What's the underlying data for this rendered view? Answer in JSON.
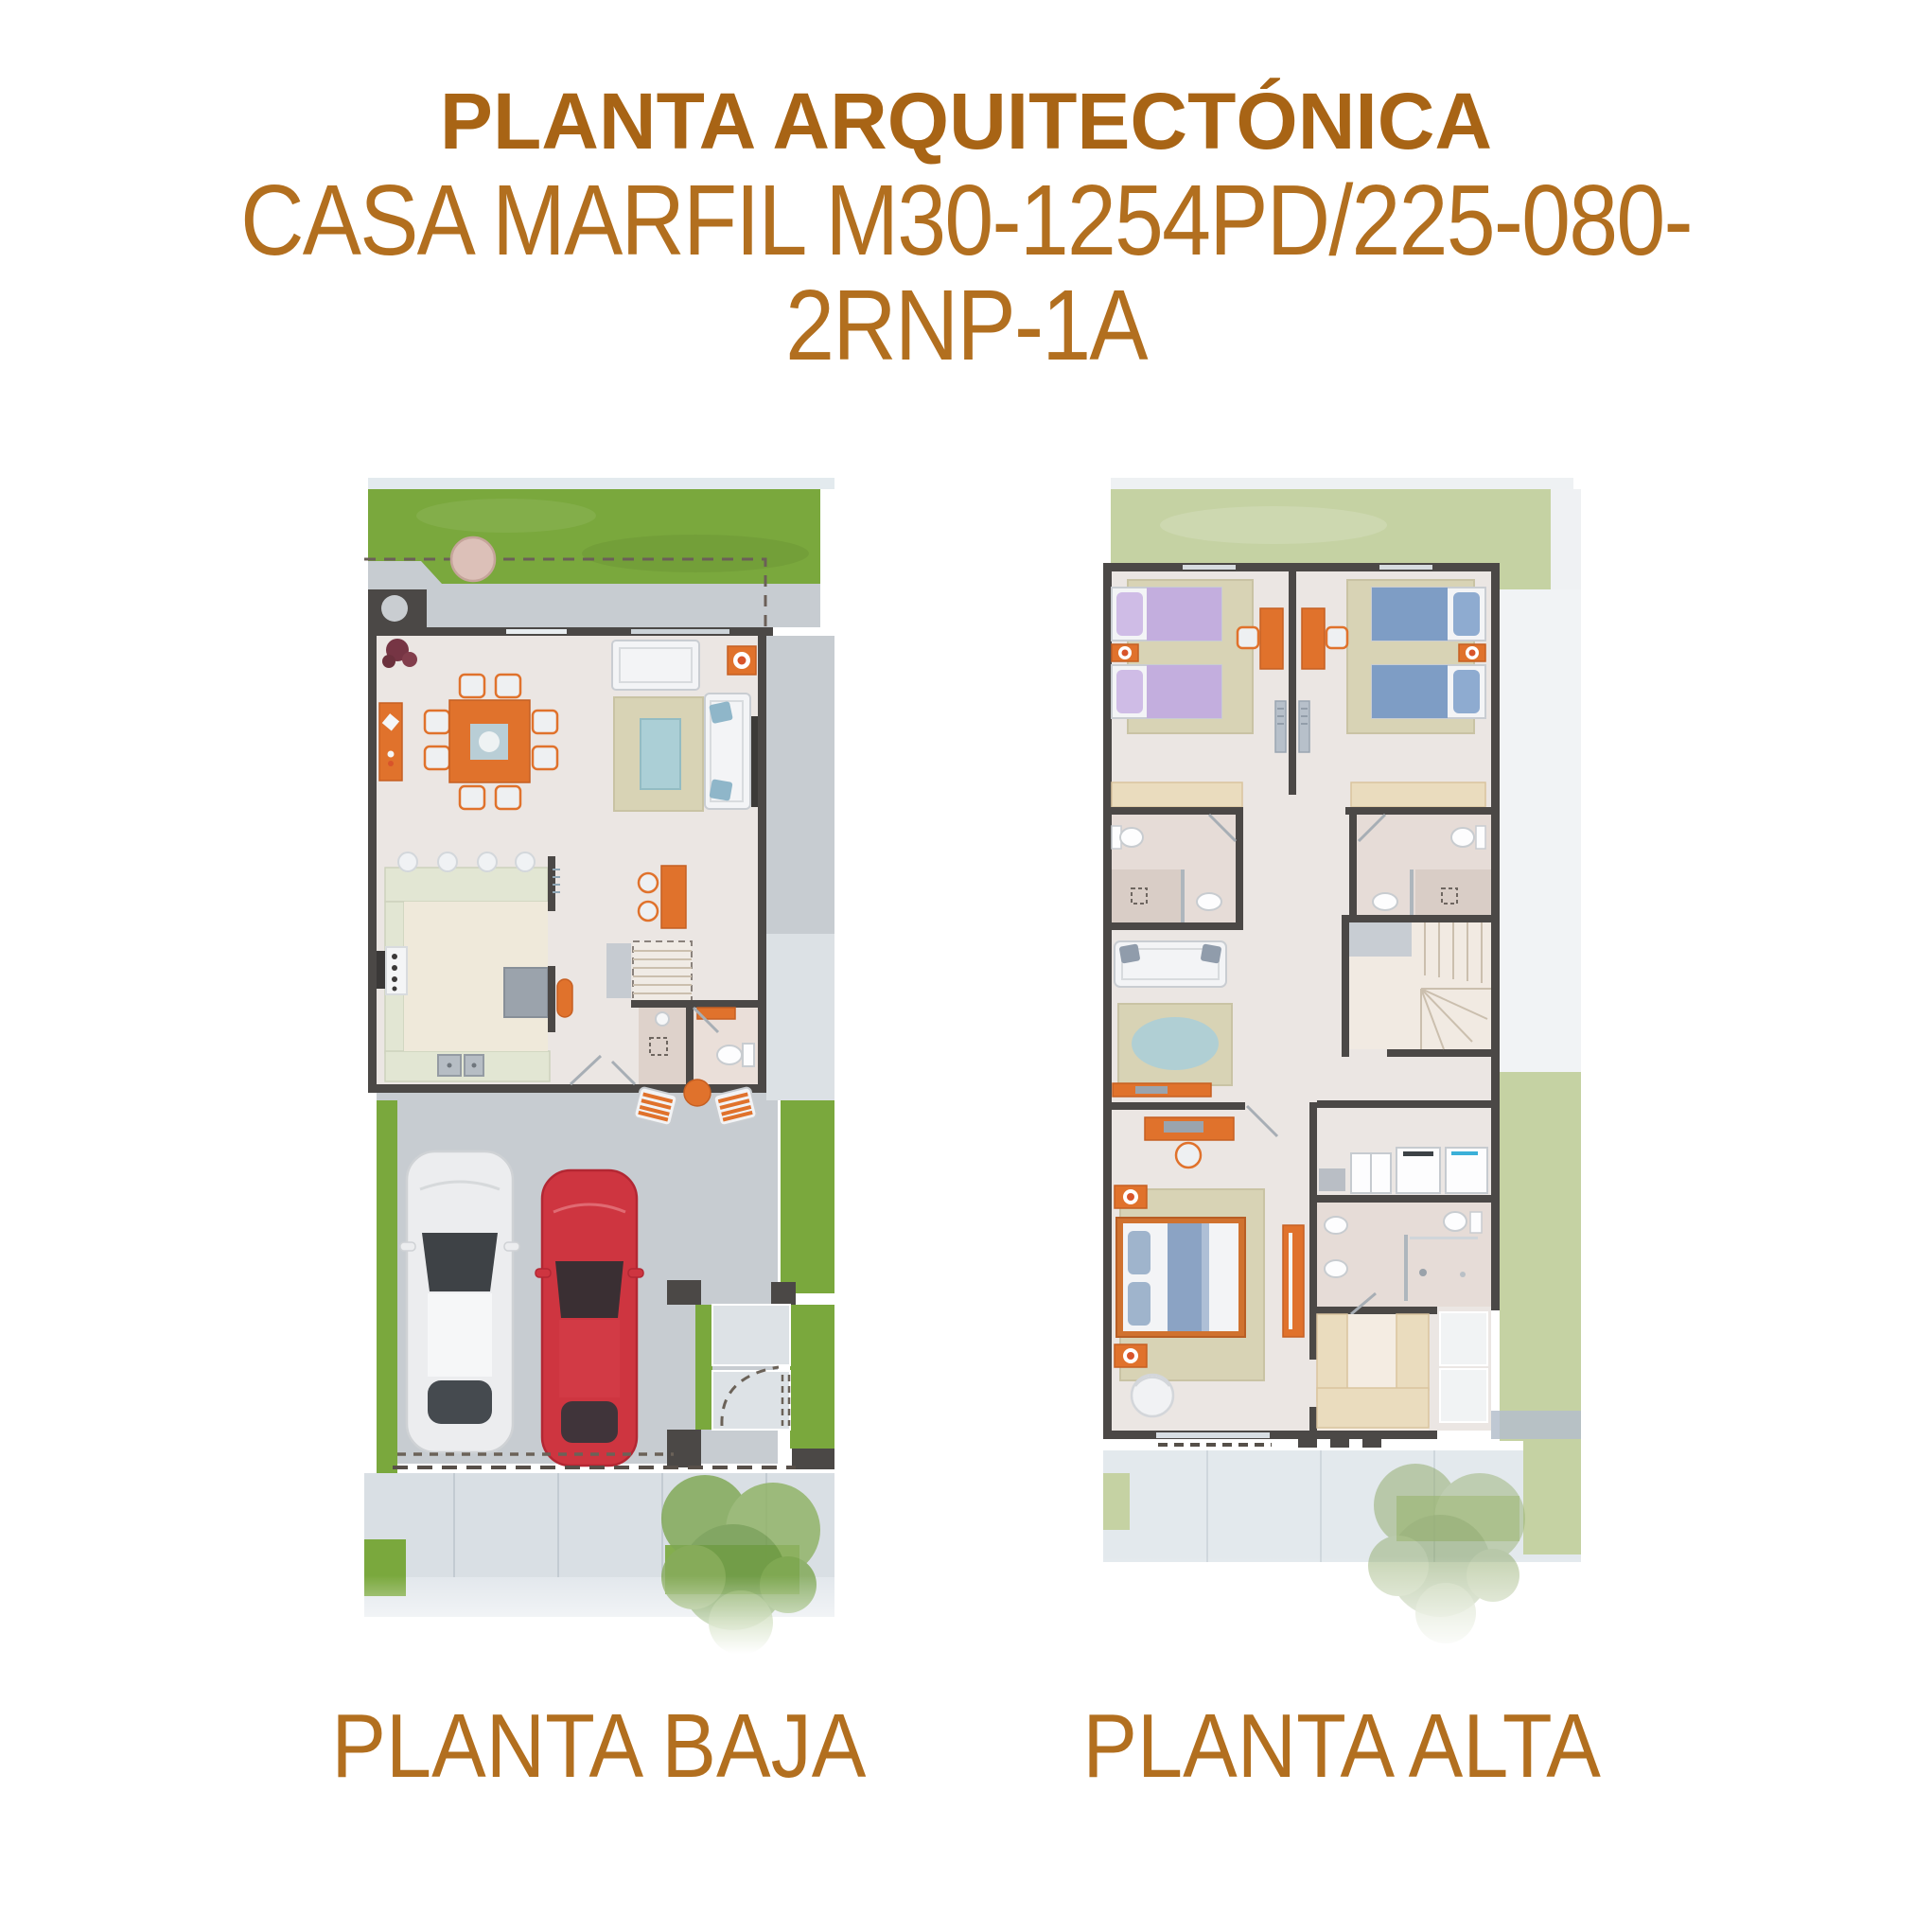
{
  "header": {
    "title": "PLANTA ARQUITECTÓNICA",
    "subtitle": "CASA MARFIL M30-1254PD/225-080-2RNP-1A"
  },
  "plans": {
    "baja": {
      "label": "PLANTA BAJA"
    },
    "alta": {
      "label": "PLANTA ALTA"
    }
  },
  "colors": {
    "heading": "#A86415",
    "caption": "#B26F1F",
    "accent": "#E0722C",
    "accent_deep": "#C65F22",
    "wall": "#4B4846",
    "grass": "#7AA83D",
    "grass_pale": "#C5D2A3",
    "concrete": "#C7CCD1",
    "tile": "#DCE1E5",
    "sidewalk": "#D9DFE4",
    "floor": "#EBE6E3",
    "bath_floor": "#E6DCD7",
    "rug": "#D8D3B5",
    "rug_blue": "#ABCFD6",
    "counter": "#E2E6D3",
    "wood": "#EADCBE",
    "bed_lavender": "#C3AEDE",
    "bed_blue": "#7E9DC5",
    "car_red": "#CE3540",
    "car_white": "#ECEDEF",
    "white_furn": "#F3F4F6"
  }
}
